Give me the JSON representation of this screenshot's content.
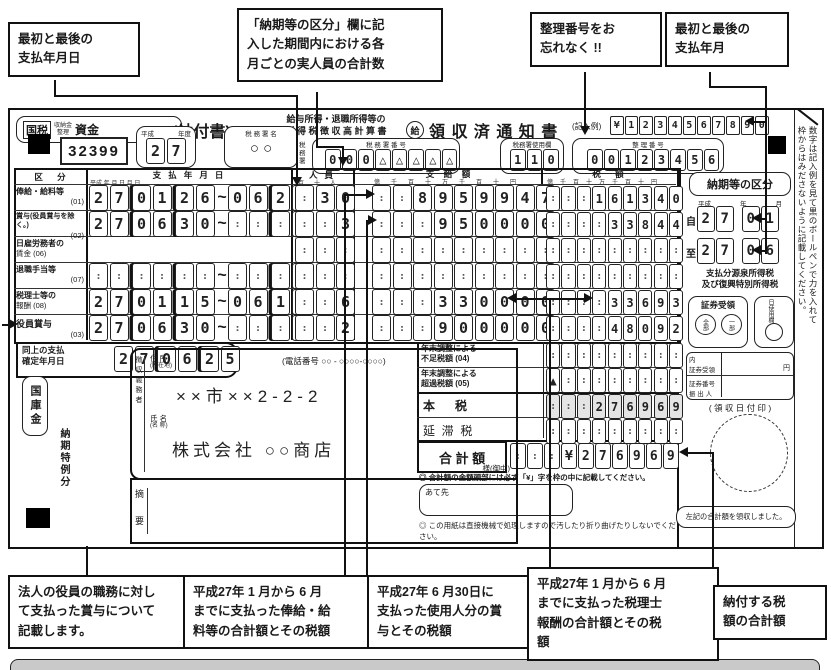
{
  "colors": {
    "ink": "#1a1a1a",
    "shaded_cell": "#e4e4e4",
    "bottom_bar": "#c9c9c9"
  },
  "callouts": {
    "top": [
      {
        "lines": [
          "最初と最後の",
          "支払年月日"
        ]
      },
      {
        "lines": [
          "「納期等の区分」欄に記",
          "入した期間内における各",
          "月ごとの実人員の合計数"
        ]
      },
      {
        "lines": [
          "整理番号をお",
          "忘れなく !!"
        ]
      },
      {
        "lines": [
          "最初と最後の",
          "支払年月"
        ]
      }
    ],
    "bottom": [
      {
        "lines": [
          "法人の役員の職務に対し",
          "て支払った賞与について",
          "記載します。"
        ]
      },
      {
        "lines": [
          "平成27年 1 月から 6 月",
          "までに支払った俸給・給",
          "料等の合計額とその税額"
        ]
      },
      {
        "lines": [
          "平成27年 6 月30日に",
          "支払った使用人分の賞",
          "与とその税額"
        ]
      },
      {
        "lines": [
          "平成27年 1 月から 6 月",
          "までに支払った税理士",
          "報酬の合計額とその税",
          "額"
        ]
      },
      {
        "lines": [
          "納付する税",
          "額の合計額"
        ]
      }
    ]
  },
  "header": {
    "fund_1": "国税",
    "fund_2": "収納金",
    "fund_3": "整理",
    "fund_4": "資金",
    "form_label": "(納付書)",
    "code": "32399",
    "era_label": "平成",
    "nendo_label": "年度",
    "nendo_cells": "27",
    "calc_title_1": "給与所得・退職所得等の",
    "calc_title_2": "所 得 税 徴 収 高 計 算 書",
    "office_hdr": "税 務 署 名",
    "office_name": "○ ○",
    "office_suffix": "税務署",
    "receipt_mark": "給",
    "receipt_title": "領 収 済 通 知 書",
    "example_label": "(記入例)",
    "example_cells": "¥1234567890",
    "office_no_hdr": "税  務  署  番  号",
    "office_no_cells": "000△△△△△",
    "use_hdr": "税務署使用欄",
    "use_cells": "110",
    "seiri_hdr": "整  理  番  号",
    "seiri_cells": "00123456"
  },
  "side_note": {
    "line1": "数字は記入例を見て黒のボールペンで力を入れて",
    "line2": "枠からはみださないように記載してください。"
  },
  "table": {
    "col_kubun": "区      分",
    "col_date": "支   払   年   月   日",
    "col_people": "人   員",
    "col_pay": "支    給    額",
    "col_tax": "税      額",
    "date_scale": "平成 年    月    日          月    日",
    "people_scale": "百十人",
    "money_scale": "億千百十万千百十円",
    "nobe": "(延)",
    "rows": [
      {
        "label": "俸給・給料等",
        "code": "(01)",
        "date": "27|01|26~06|25",
        "people": ".30",
        "pay": "..8959947",
        "tax": "...161340"
      },
      {
        "label": "賞与(役員賞与を除く。)",
        "code": "(02)",
        "date": "27|06|30~..|..",
        "people": "..3",
        "pay": "...950000",
        "tax": "....33844"
      },
      {
        "label": "日雇労務者の",
        "code": "賃金 (06)",
        "date": "",
        "people": "...",
        "pay": ".........",
        "tax": "........."
      },
      {
        "label": "退職手当等",
        "code": "(07)",
        "date": "..|..|..~..|..",
        "people": "...",
        "pay": ".........",
        "tax": "........."
      },
      {
        "label": "税理士等の",
        "code": "報酬 (08)",
        "date": "27|01|15~06|15",
        "people": "..6",
        "pay": "...330000",
        "tax": "....33693"
      },
      {
        "label": "役員賞与",
        "code": "(03)",
        "date": "27|06|30~..|..",
        "people": "..2",
        "pay": "...900000",
        "tax": "....48092"
      }
    ],
    "kakutei_1": "同上の支払",
    "kakutei_2": "確定年月日",
    "kakutei_cells": "27|06|25"
  },
  "lower": {
    "rows": [
      {
        "l1": "年末調整による",
        "l2": "不足税額 (04)",
        "cells": "........."
      },
      {
        "l1": "年末調整による",
        "l2": "超過税額 (05)",
        "cells": "▲........"
      },
      {
        "l1": "本      税",
        "l2": "",
        "cells": "...276969"
      },
      {
        "l1": "延  滞  税",
        "l2": "",
        "cells": "........."
      }
    ],
    "total_label": "合 計 額",
    "total_cells": "...¥276969",
    "note1": "◎ 合計額の金額頭部には必ず「¥」字を枠の中に記載してください。",
    "atesaki": "あて先",
    "note2": "◎ この用紙は直接機械で処理しますので汚したり折り曲げたりしないでください。"
  },
  "payer": {
    "treasury": "国庫金",
    "tokurei": "納期特例分",
    "collector": "徴収義務者",
    "addr_l1": "住 所",
    "addr_l2": "(所在地)",
    "phone": "(電話番号  ○○ - ○○○○-○○○○)",
    "address": "××市××2-2-2",
    "name_l1": "氏 名",
    "name_l2": "(名 称)",
    "name": "株式会社 ○○商店",
    "honorific": "様(御中)",
    "tekiyo_1": "摘",
    "tekiyo_2": "要"
  },
  "noki": {
    "title": "納期等の区分",
    "era": "平成",
    "yy": "年",
    "mm": "月",
    "from_label": "自",
    "from_cells": "27 01",
    "to_label": "至",
    "to_cells": "27 06",
    "desc1": "支払分源泉所得税",
    "desc2": "及び復興特別所得税",
    "shoken_title": "証券受領",
    "stamp1": "全部",
    "stamp2": "一部",
    "hi_label": "日使用欄",
    "uchi_l1": "内",
    "uchi_l2": "証券受領",
    "yen": "円",
    "no_l1": "証券番号",
    "no_l2": "振 出 人",
    "stamp_area": "(  領  収  日  付  印  )",
    "received": "左記の合計額を領収しました。"
  }
}
